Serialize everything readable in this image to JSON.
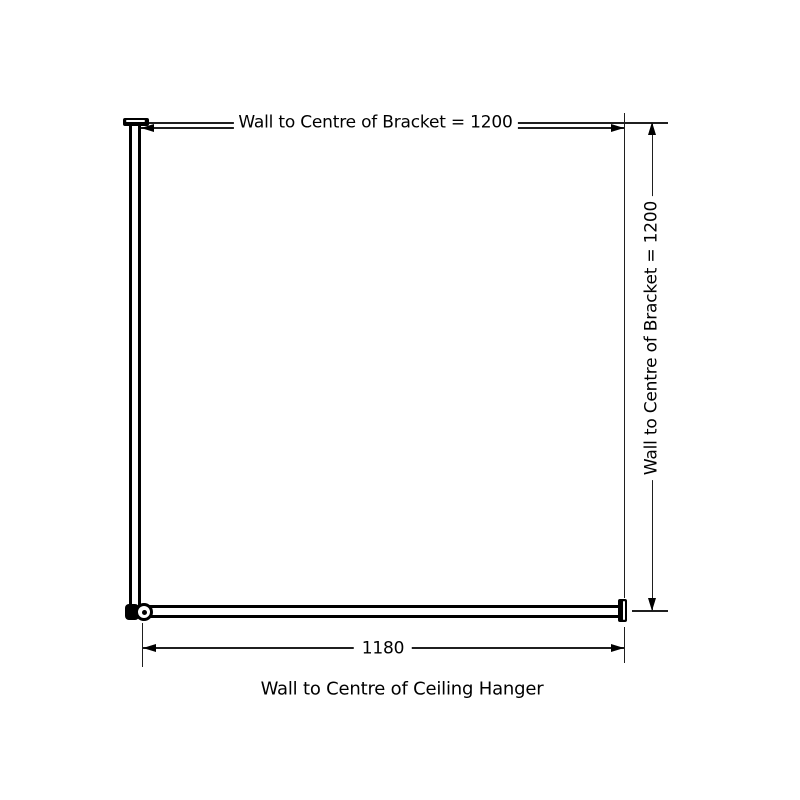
{
  "diagram": {
    "type": "technical-dimension-drawing",
    "subject": "L-shaped corner shower curtain rail with ceiling hanger",
    "top_dimension": {
      "label": "Wall to Centre of Bracket = 1200",
      "value": 1200
    },
    "right_dimension": {
      "label": "Wall to Centre of Bracket = 1200",
      "value": 1200
    },
    "bottom_dimension": {
      "value": "1180",
      "caption": "Wall to Centre of Ceiling Hanger"
    },
    "colors": {
      "background": "#ffffff",
      "rail_outline": "#000000",
      "dimension_line": "#1f1f1f",
      "text": "#000000"
    }
  }
}
